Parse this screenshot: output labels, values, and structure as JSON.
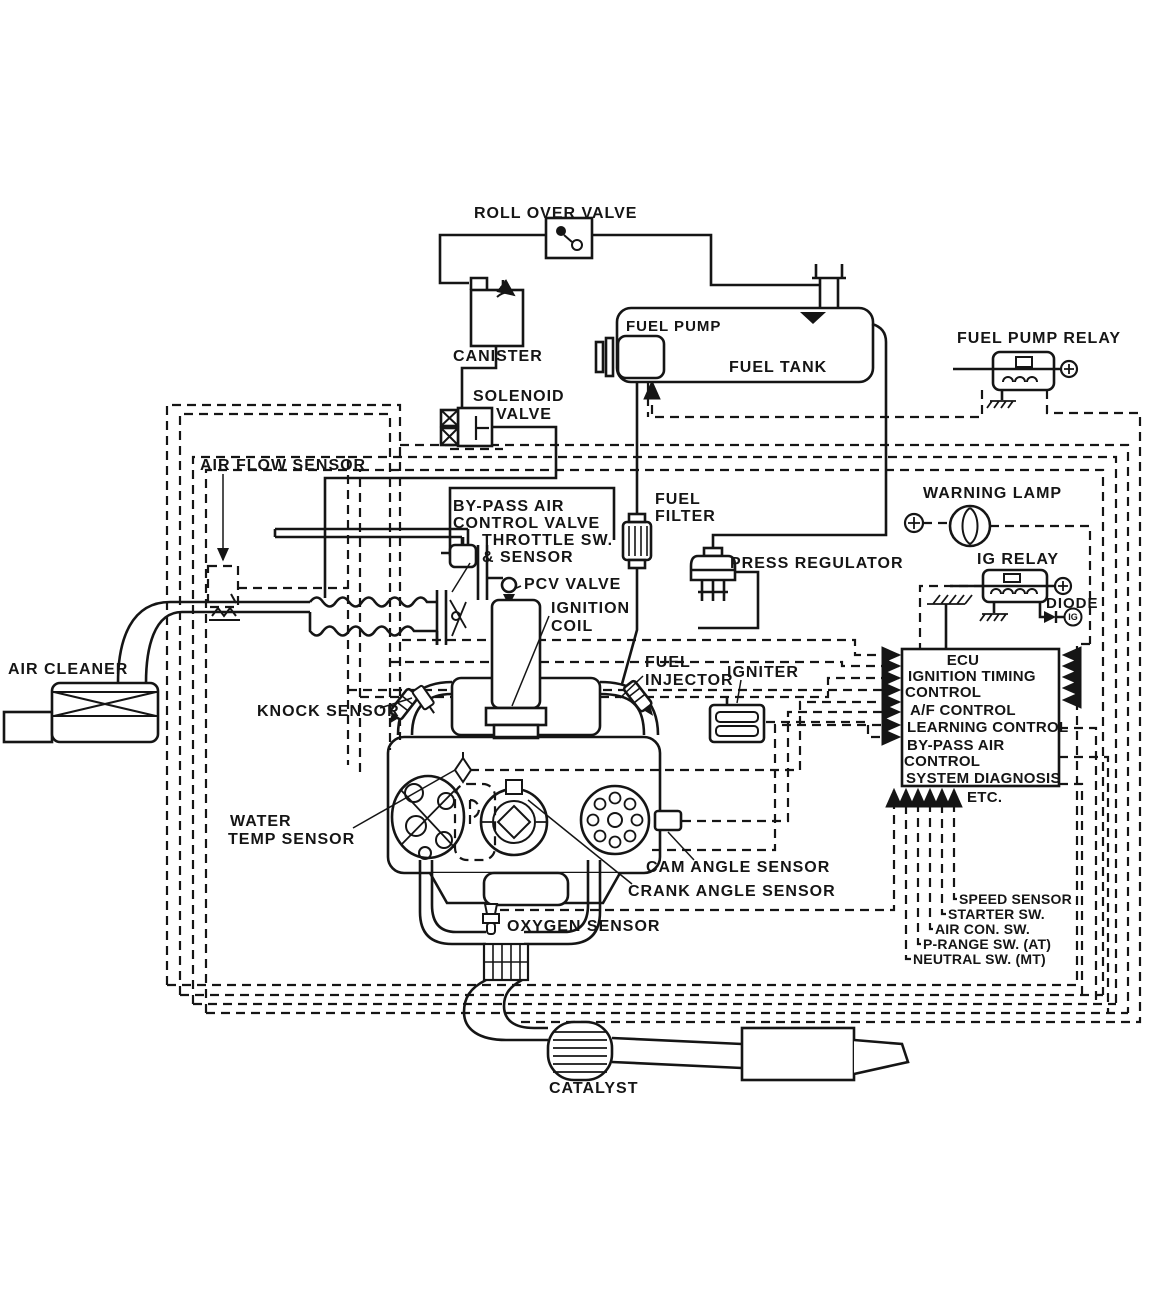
{
  "diagram_title": "Engine fuel / ignition control system diagram",
  "colors": {
    "ink": "#151515",
    "paper": "#ffffff"
  },
  "labels": {
    "roll_over_valve": "ROLL OVER VALVE",
    "canister": "CANISTER",
    "solenoid_1": "SOLENOID",
    "solenoid_2": "VALVE",
    "fuel_pump": "FUEL PUMP",
    "fuel_tank": "FUEL TANK",
    "fuel_pump_relay": "FUEL PUMP RELAY",
    "air_flow_sensor": "AIR FLOW SENSOR",
    "bypass_1": "BY-PASS AIR",
    "bypass_2": "CONTROL VALVE",
    "bypass_3": "THROTTLE SW.",
    "bypass_4": "& SENSOR",
    "fuel_filter_1": "FUEL",
    "fuel_filter_2": "FILTER",
    "warning_lamp": "WARNING LAMP",
    "pcv_valve": "PCV VALVE",
    "press_regulator": "PRESS REGULATOR",
    "ig_relay": "IG RELAY",
    "diode": "DIODE",
    "ignition_1": "IGNITION",
    "ignition_2": "COIL",
    "air_cleaner": "AIR CLEANER",
    "fuel_injector_1": "FUEL",
    "fuel_injector_2": "INJECTOR",
    "igniter": "IGNITER",
    "knock_sensor": "KNOCK SENSOR",
    "ecu_1": "ECU",
    "ecu_2": "IGNITION TIMING",
    "ecu_3": "CONTROL",
    "ecu_4": "A/F CONTROL",
    "ecu_5": "LEARNING CONTROL",
    "ecu_6": "BY-PASS AIR",
    "ecu_7": "CONTROL",
    "ecu_8": "SYSTEM DIAGNOSIS",
    "ecu_9": "ETC.",
    "water_1": "WATER",
    "water_2": "TEMP SENSOR",
    "cam_angle": "CAM ANGLE SENSOR",
    "crank_angle": "CRANK ANGLE SENSOR",
    "oxygen": "OXYGEN SENSOR",
    "speed": "SPEED SENSOR",
    "starter": "STARTER SW.",
    "aircon": "AIR CON. SW.",
    "prange": "P-RANGE SW. (AT)",
    "neutral": "NEUTRAL SW. (MT)",
    "catalyst": "CATALYST",
    "ig_terminal": "IG"
  }
}
